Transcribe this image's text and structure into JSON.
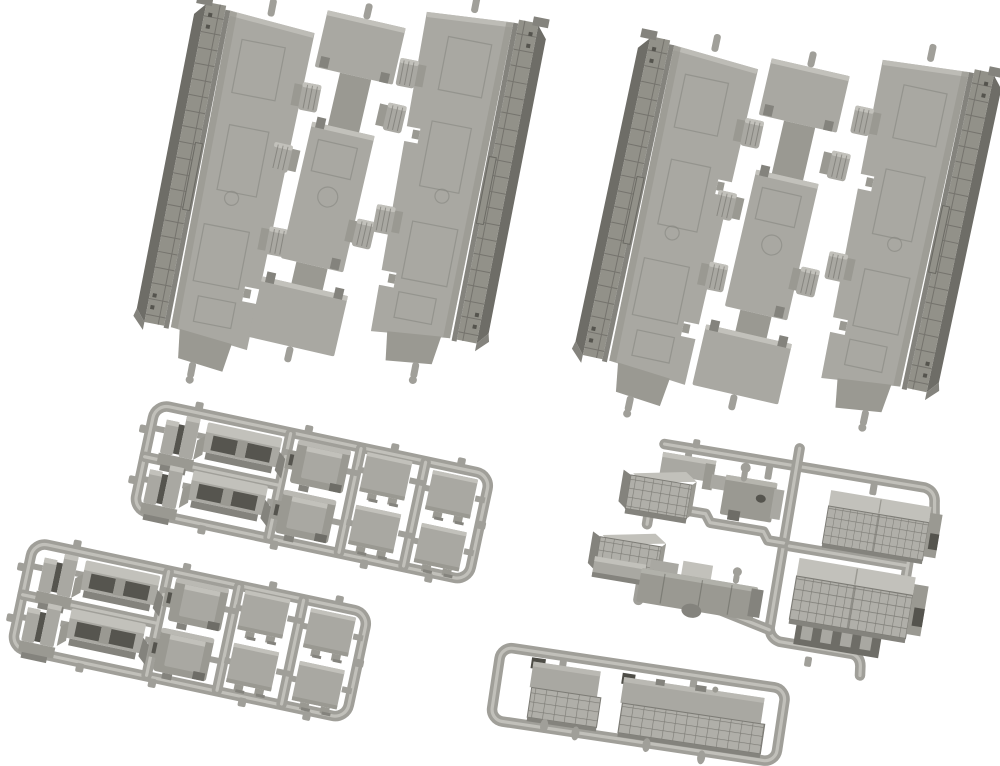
{
  "scene": {
    "description": "Product photo of gray injection-molded plastic model railway parts on a white background: two sets of three long underfloor chassis pieces at the top, two identical small-parts sprues at the lower left, an equipment sprue with grille boxes at the right, and a small sprue with two louvered panels at the bottom center.",
    "background_color": "#ffffff"
  },
  "colors": {
    "bg": "#ffffff",
    "base": "#a9a8a2",
    "baseShade": "#9a9992",
    "light": "#c2c1bb",
    "tube": "#a09f99",
    "tubeHi": "#c7c6c0",
    "railFace": "#929189",
    "dark1": "#84837d",
    "dark2": "#6e6d67",
    "dark3": "#55544e",
    "lineDark": "#6b6a64",
    "gridFill": "#b0afa9",
    "gridLine": "#7c7b75",
    "emboss": "#807f79",
    "cavity": "#56554f",
    "capDark": "#4e4d47"
  },
  "groups": [
    {
      "id": "floor-set-left",
      "label": "floor piece set (upper left)",
      "pieces": [
        "left floor plate with side rail",
        "center floor strip",
        "right floor plate with side rail"
      ]
    },
    {
      "id": "floor-set-right",
      "label": "floor piece set (upper right)",
      "pieces": [
        "left floor plate with side rail",
        "center floor strip",
        "right floor plate with side rail"
      ]
    },
    {
      "id": "detail-sprue-upper",
      "label": "detail parts sprue (upper)",
      "parts": {
        "clip_parts": 2,
        "coupler_brackets": 2,
        "latch_boxes": 2,
        "square_lids": 4
      }
    },
    {
      "id": "detail-sprue-lower",
      "label": "detail parts sprue (lower)",
      "parts": {
        "clip_parts": 2,
        "coupler_brackets": 2,
        "latch_boxes": 2,
        "square_lids": 4
      }
    },
    {
      "id": "equipment-sprue",
      "label": "underfloor equipment sprue (right)",
      "parts": {
        "small_grille_boxes": 2,
        "flange_plate": 1,
        "pin_bracket": 1,
        "tank_block": 1,
        "large_grille_panels": 2,
        "slotted_base": 1
      }
    },
    {
      "id": "louver-sprue",
      "label": "louvered panel sprue (bottom)",
      "parts": {
        "louver_panels": 2
      }
    }
  ]
}
